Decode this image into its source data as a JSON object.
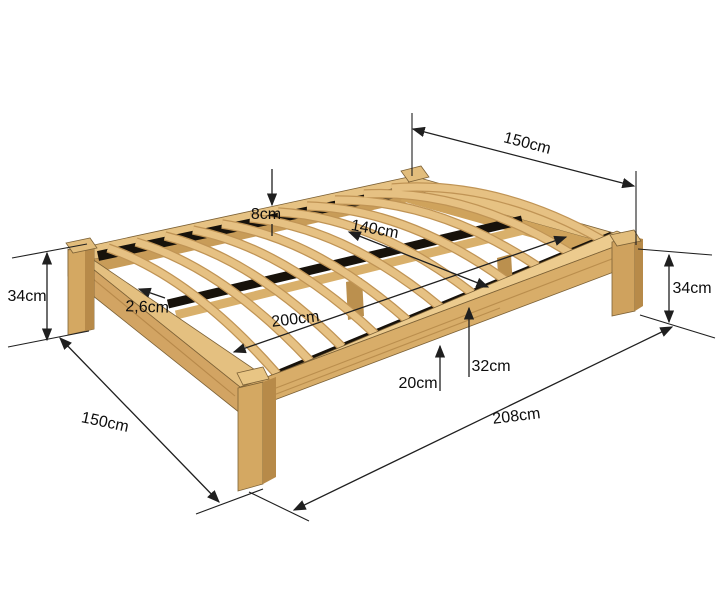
{
  "figure": {
    "kind": "product-dimension-diagram",
    "subject": "wooden slatted bed frame, perspective view with measurements"
  },
  "colors": {
    "background": "#ffffff",
    "wood_top": "#e6c283",
    "wood_face": "#d8ad69",
    "wood_side_dark": "#b78a49",
    "wood_inner": "#c89c58",
    "slat": "#e6c183",
    "slat_edge": "#c09455",
    "gap_dark": "#17120b",
    "dimension_line": "#1f1f1f",
    "label_text": "#0d0d0d"
  },
  "dimensions": {
    "top_width": {
      "label": "150cm",
      "meaning": "head end outer width"
    },
    "rail_rim": {
      "label": "8cm",
      "meaning": "rail rim height above slats"
    },
    "inner_width": {
      "label": "140cm",
      "meaning": "inner slat width"
    },
    "slat_thickness": {
      "label": "2,6cm",
      "meaning": "slat thickness"
    },
    "left_height": {
      "label": "34cm",
      "meaning": "frame height left"
    },
    "inner_length": {
      "label": "200cm",
      "meaning": "inner length"
    },
    "slat_height": {
      "label": "32cm",
      "meaning": "floor to slat top"
    },
    "clearance": {
      "label": "20cm",
      "meaning": "floor to rail underside"
    },
    "right_height": {
      "label": "34cm",
      "meaning": "frame height right"
    },
    "foot_width": {
      "label": "150cm",
      "meaning": "foot end outer width"
    },
    "outer_length": {
      "label": "208cm",
      "meaning": "outer length"
    }
  }
}
